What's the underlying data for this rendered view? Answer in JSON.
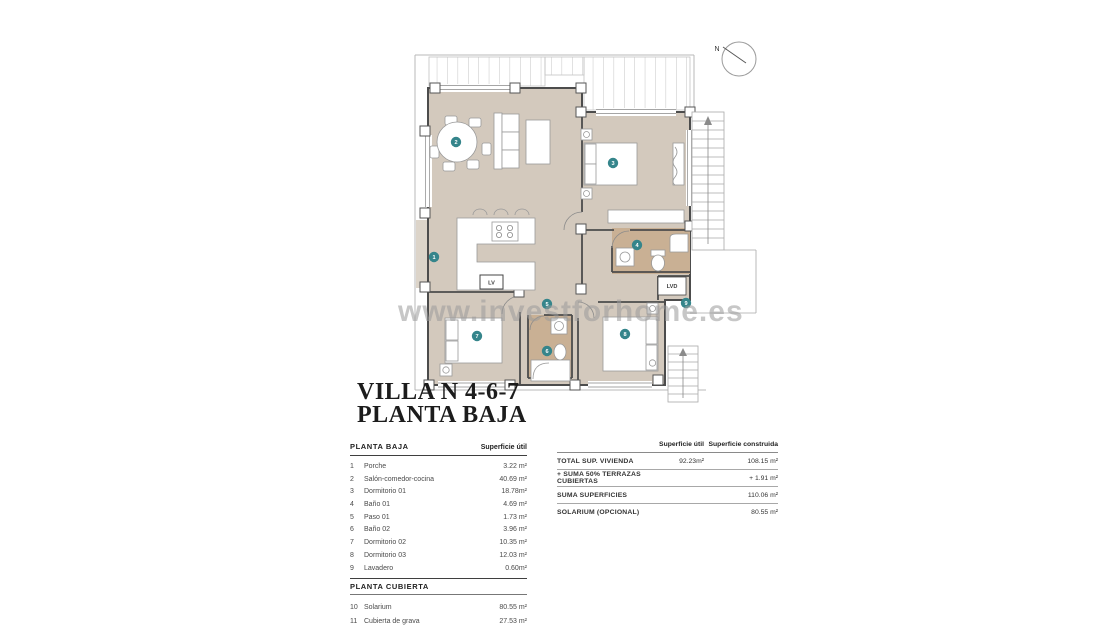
{
  "title": {
    "line1": "VILLA N 4-6-7",
    "line2": "PLANTA BAJA"
  },
  "watermark": "www.investforhome.es",
  "compass": {
    "label": "N"
  },
  "plan": {
    "markers": [
      {
        "n": "1"
      },
      {
        "n": "2"
      },
      {
        "n": "3"
      },
      {
        "n": "4"
      },
      {
        "n": "5"
      },
      {
        "n": "6"
      },
      {
        "n": "7"
      },
      {
        "n": "8"
      },
      {
        "n": "9"
      }
    ],
    "labels": {
      "lv": "LV",
      "lvd": "LVD"
    }
  },
  "left_table": {
    "section1": {
      "header": "PLANTA BAJA",
      "col_header": "Superficie útil",
      "rows": [
        {
          "num": "1",
          "name": "Porche",
          "area": "3.22 m²"
        },
        {
          "num": "2",
          "name": "Salón-comedor-cocina",
          "area": "40.69 m²"
        },
        {
          "num": "3",
          "name": "Dormitorio 01",
          "area": "18.78m²"
        },
        {
          "num": "4",
          "name": "Baño 01",
          "area": "4.69 m²"
        },
        {
          "num": "5",
          "name": "Paso 01",
          "area": "1.73 m²"
        },
        {
          "num": "6",
          "name": "Baño 02",
          "area": "3.96 m²"
        },
        {
          "num": "7",
          "name": "Dormitorio 02",
          "area": "10.35 m²"
        },
        {
          "num": "8",
          "name": "Dormitorio 03",
          "area": "12.03 m²"
        },
        {
          "num": "9",
          "name": "Lavadero",
          "area": "0.60m²"
        }
      ]
    },
    "section2": {
      "header": "PLANTA CUBIERTA",
      "rows": [
        {
          "num": "10",
          "name": "Solarium",
          "area": "80.55 m²"
        },
        {
          "num": "11",
          "name": "Cubierta de grava",
          "area": "27.53 m²"
        }
      ]
    }
  },
  "summary_table": {
    "col1_header": "Superficie útil",
    "col2_header": "Superficie construida",
    "rows": [
      {
        "label": "TOTAL SUP. VIVIENDA",
        "util": "92.23m²",
        "construida": "108.15 m²"
      },
      {
        "label": "+ SUMA 50% TERRAZAS CUBIERTAS",
        "util": "",
        "construida": "+ 1.91 m²"
      },
      {
        "label": "SUMA SUPERFICIES",
        "util": "",
        "construida": "110.06 m²"
      },
      {
        "label": "SOLARIUM (OPCIONAL)",
        "util": "",
        "construida": "80.55 m²"
      }
    ]
  },
  "colors": {
    "accent_teal": "#35858b",
    "floor_tan": "#d3c9bd",
    "bath_tan": "#c9b094"
  }
}
